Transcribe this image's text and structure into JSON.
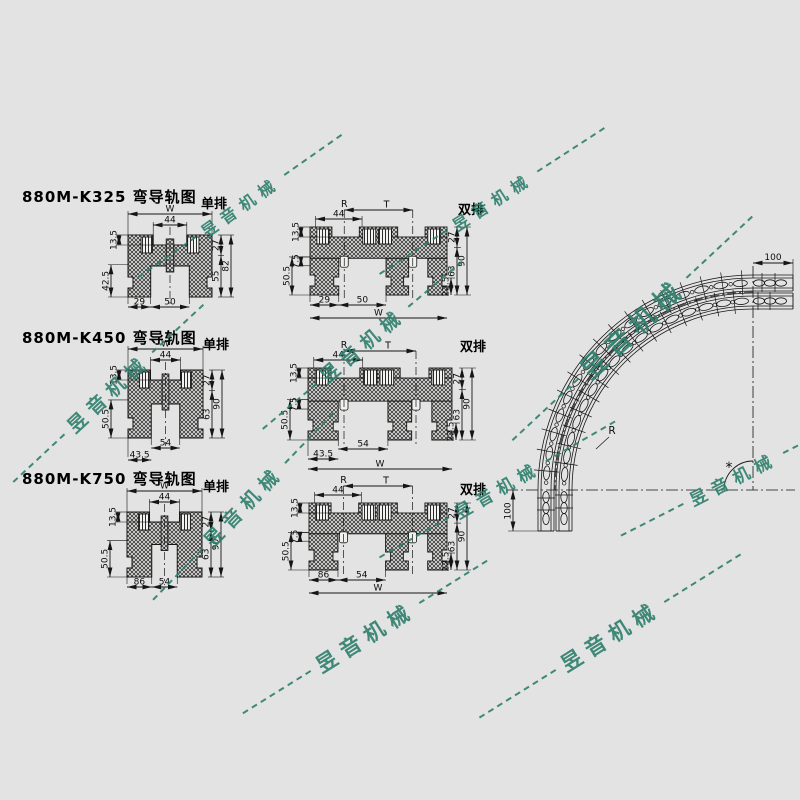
{
  "page": {
    "background": "#e2e3e2",
    "line_color": "#151515"
  },
  "watermark": {
    "text": "昱音机械",
    "color": "#2e7f6d"
  },
  "sections": [
    {
      "title": "880M-K325 弯导轨图",
      "single": {
        "label": "单排",
        "dims": {
          "top_width": "W",
          "groove_width": "44",
          "tab_height": "13.5",
          "lower_height": "42.5",
          "bottom_left": "29",
          "bottom_center": "50",
          "right_top": "27",
          "right_mid": "55",
          "right_total": "82"
        }
      },
      "double": {
        "label": "双排",
        "dims": {
          "groove_width": "44",
          "radius_line": "R",
          "track_spacing": "T",
          "tab_height": "13.5",
          "step": "7.5",
          "lower_height": "50.5",
          "bottom_left": "29",
          "bottom_center": "50",
          "bottom_width": "W",
          "right_top": "27",
          "right_mid": "63",
          "right_total": "90",
          "right_step": "22.5"
        }
      }
    },
    {
      "title": "880M-K450 弯导轨图",
      "single": {
        "label": "单排",
        "dims": {
          "top_width": "W",
          "groove_width": "44",
          "tab_height": "13.5",
          "lower_height": "50.5",
          "bottom_offset": "43.5",
          "bottom_center": "54",
          "right_top": "27",
          "right_mid": "63",
          "right_total": "90"
        }
      },
      "double": {
        "label": "双排",
        "dims": {
          "groove_width": "44",
          "radius_line": "R",
          "track_spacing": "T",
          "tab_height": "13.5",
          "step": "7.5",
          "lower_height": "50.5",
          "bottom_center": "54",
          "bottom_offset": "43.5",
          "bottom_width": "W",
          "right_top": "27",
          "right_mid": "63",
          "right_total": "90",
          "right_step": "22.5"
        }
      }
    },
    {
      "title": "880M-K750 弯导轨图",
      "single": {
        "label": "单排",
        "dims": {
          "top_width": "W",
          "groove_width": "44",
          "tab_height": "13.5",
          "lower_height": "50.5",
          "bottom_left": "86",
          "bottom_center": "54",
          "right_top": "27",
          "right_mid": "63",
          "right_total": "90"
        }
      },
      "double": {
        "label": "双排",
        "dims": {
          "groove_width": "44",
          "radius_line": "R",
          "track_spacing": "T",
          "tab_height": "13.5",
          "step": "7.5",
          "lower_height": "50.5",
          "bottom_left": "86",
          "bottom_center": "54",
          "bottom_width": "W",
          "right_top": "27",
          "right_mid": "63",
          "right_total": "90",
          "right_step": "22.5"
        }
      }
    }
  ],
  "curve": {
    "end_length_top": "100",
    "end_length_side": "100",
    "radius_label": "R",
    "angle_label": "*"
  }
}
